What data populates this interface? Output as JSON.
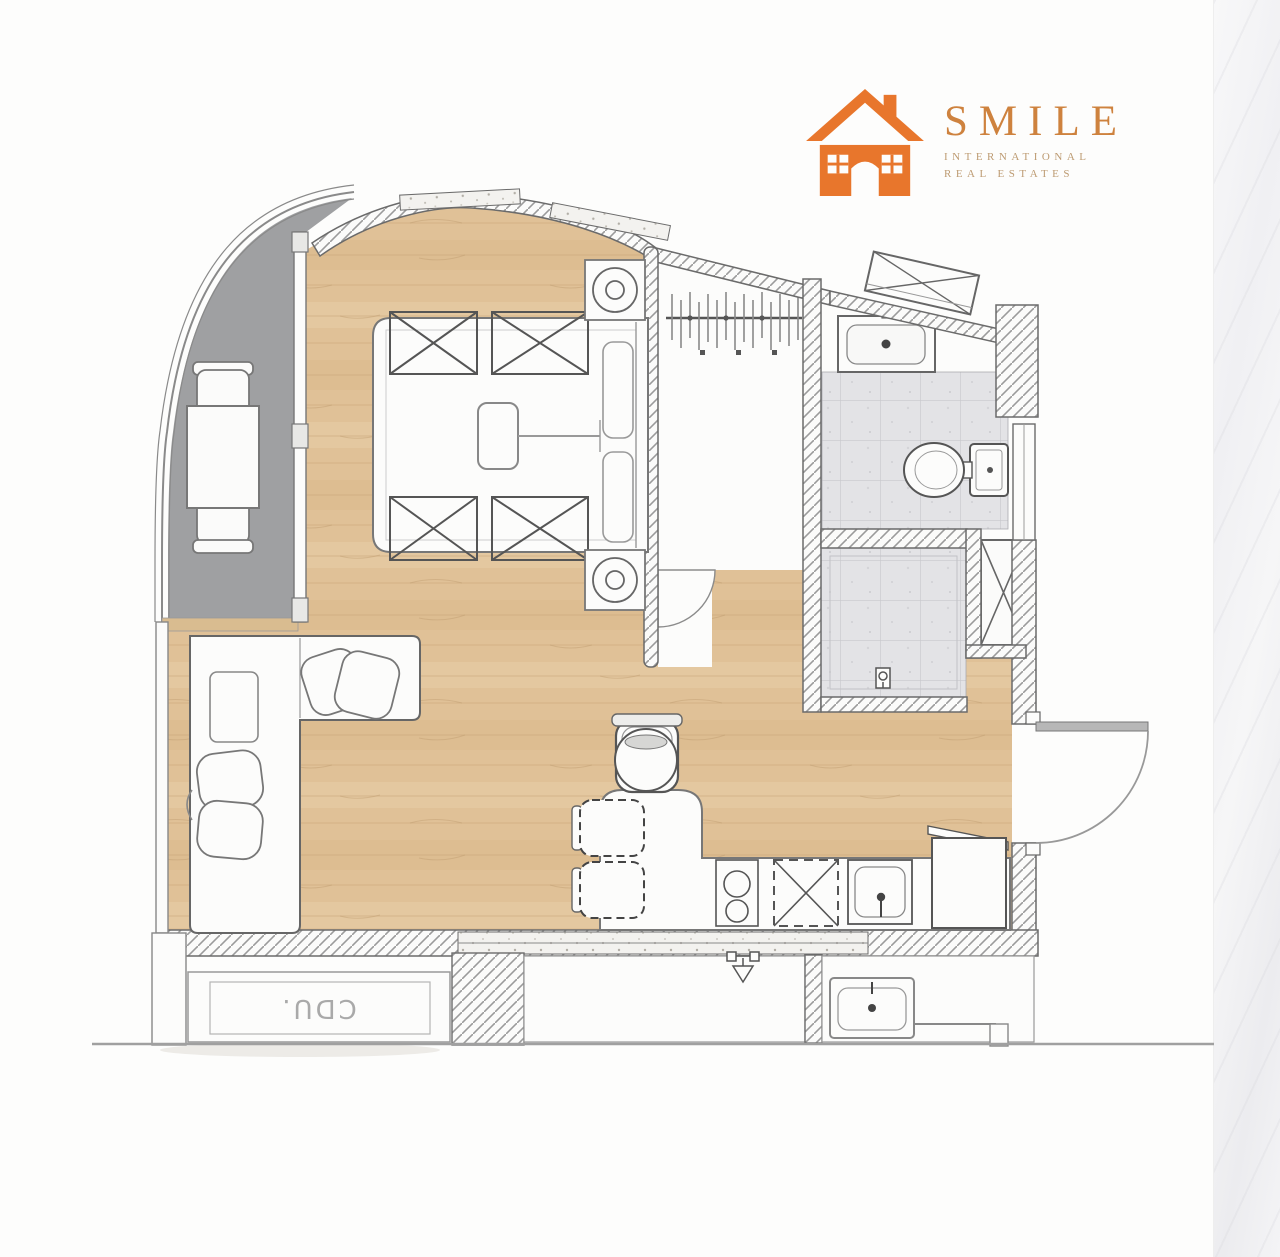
{
  "brand": {
    "name": "SMILE",
    "subtitle_line1": "INTERNATIONAL",
    "subtitle_line2": "REAL ESTATES",
    "icon": "house-icon",
    "colors": {
      "icon_orange": "#E8762C",
      "name_color": "#CE823E",
      "subtitle_color": "#BD9B72"
    }
  },
  "floor_plan": {
    "labels": {
      "condenser_unit": "CDU."
    },
    "colors": {
      "wood_floor": "#E0C197",
      "balcony_floor": "#9FA0A2",
      "tile_floor": "#E3E3E6",
      "wall_hatch_line": "#9B9B9B",
      "outline": "#666666"
    }
  }
}
